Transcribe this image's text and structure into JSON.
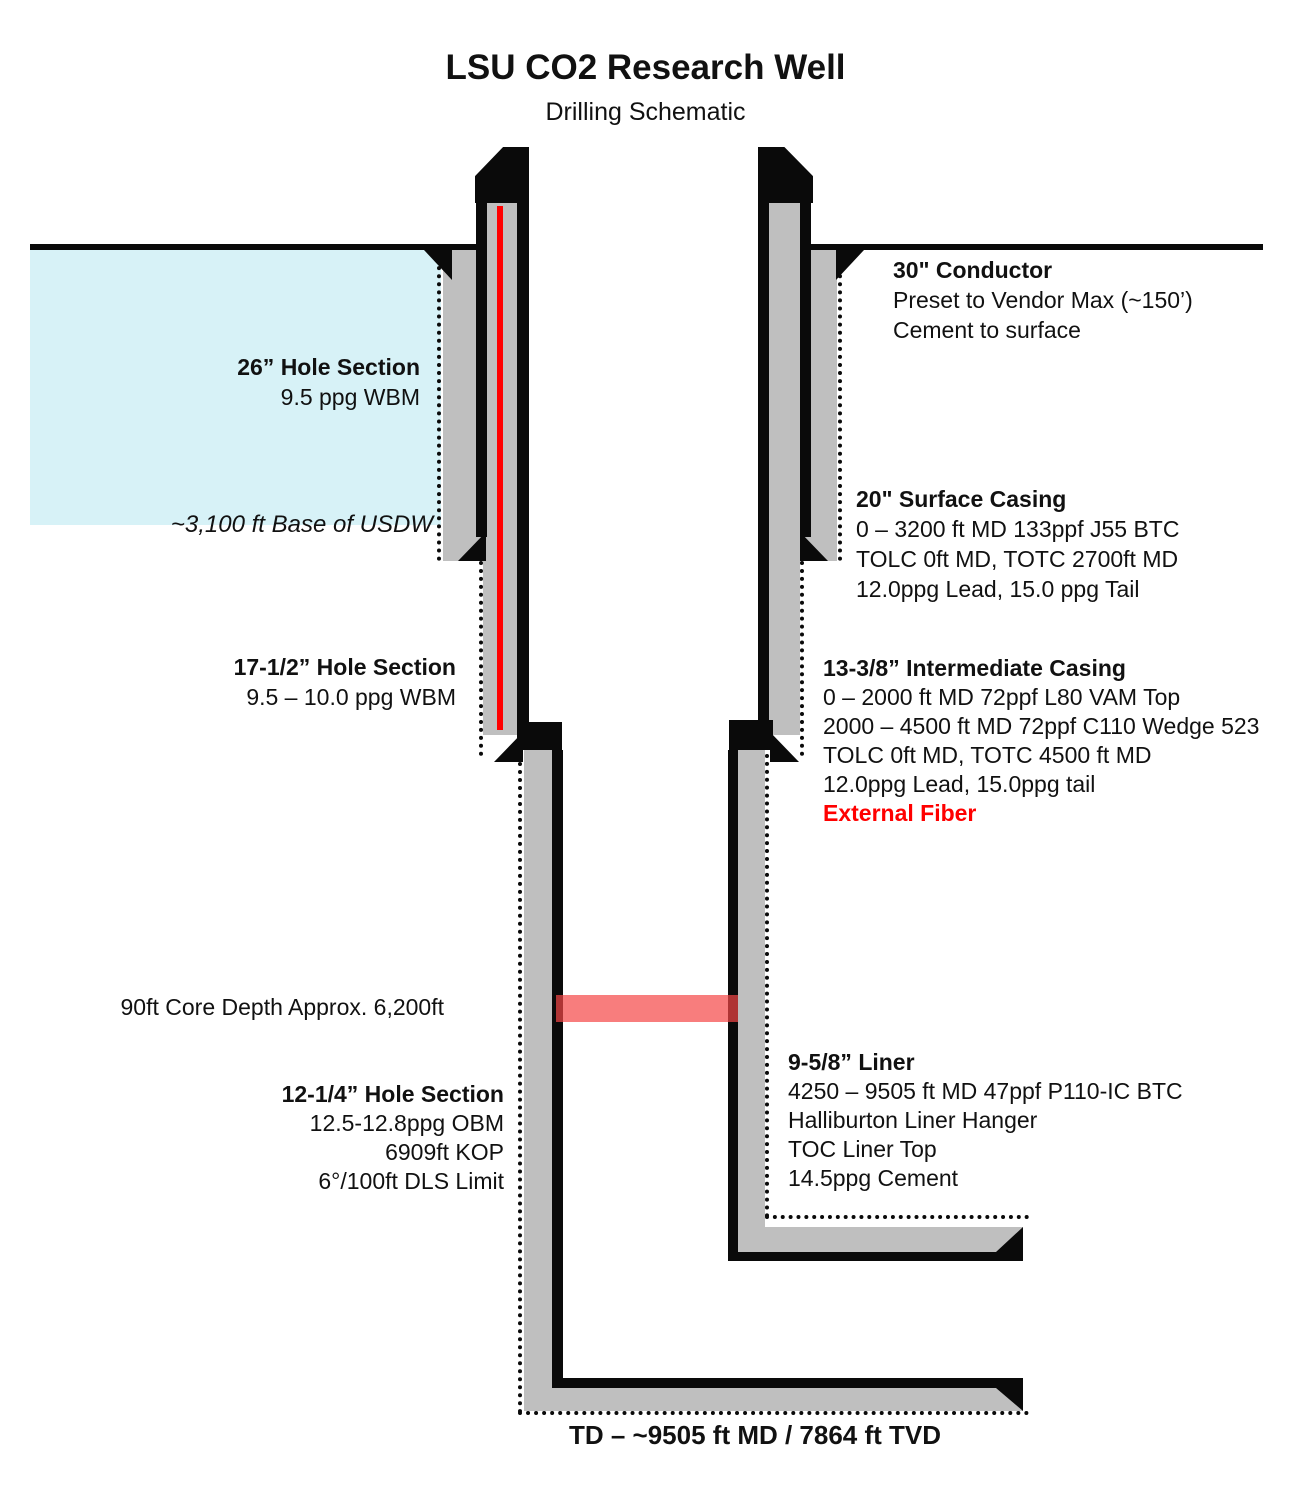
{
  "header": {
    "title": "LSU CO2 Research Well",
    "subtitle": "Drilling Schematic"
  },
  "labels": {
    "conductor": {
      "title": "30\" Conductor",
      "lines": [
        "Preset to Vendor Max (~150’)",
        "Cement to surface"
      ]
    },
    "hole26": {
      "title": "26” Hole Section",
      "lines": [
        "9.5 ppg WBM"
      ]
    },
    "usdw": {
      "text": "~3,100 ft Base of USDW"
    },
    "surface_casing": {
      "title": "20\" Surface Casing",
      "lines": [
        "0 – 3200 ft MD 133ppf J55 BTC",
        "TOLC 0ft MD, TOTC 2700ft MD",
        "12.0ppg Lead, 15.0 ppg Tail"
      ]
    },
    "hole17": {
      "title": "17-1/2” Hole Section",
      "lines": [
        "9.5 – 10.0 ppg WBM"
      ]
    },
    "intermediate_casing": {
      "title": "13-3/8” Intermediate Casing",
      "lines": [
        "0 – 2000 ft MD 72ppf L80 VAM Top",
        "2000 – 4500 ft MD 72ppf C110 Wedge 523",
        "TOLC 0ft MD, TOTC 4500 ft MD",
        "12.0ppg Lead, 15.0ppg tail"
      ],
      "highlight": "External Fiber"
    },
    "core": {
      "text": "90ft Core Depth Approx. 6,200ft"
    },
    "hole12": {
      "title": "12-1/4” Hole Section",
      "lines": [
        "12.5-12.8ppg OBM",
        "6909ft KOP",
        "6°/100ft DLS Limit"
      ]
    },
    "liner": {
      "title": "9-5/8” Liner",
      "lines": [
        "4250 – 9505 ft MD 47ppf P110-IC BTC",
        "Halliburton Liner Hanger",
        "TOC Liner Top",
        "14.5ppg Cement"
      ]
    },
    "td": {
      "text": "TD – ~9505 ft MD / 7864 ft TVD"
    }
  },
  "colors": {
    "aquifer_blue": "#d7f2f7",
    "casing_gray": "#bfbfbf",
    "outline_black": "#0a0a0a",
    "fiber_red": "#ff0000",
    "core_band_pink": "#f87c7c",
    "highlight_red": "#ff0000"
  }
}
